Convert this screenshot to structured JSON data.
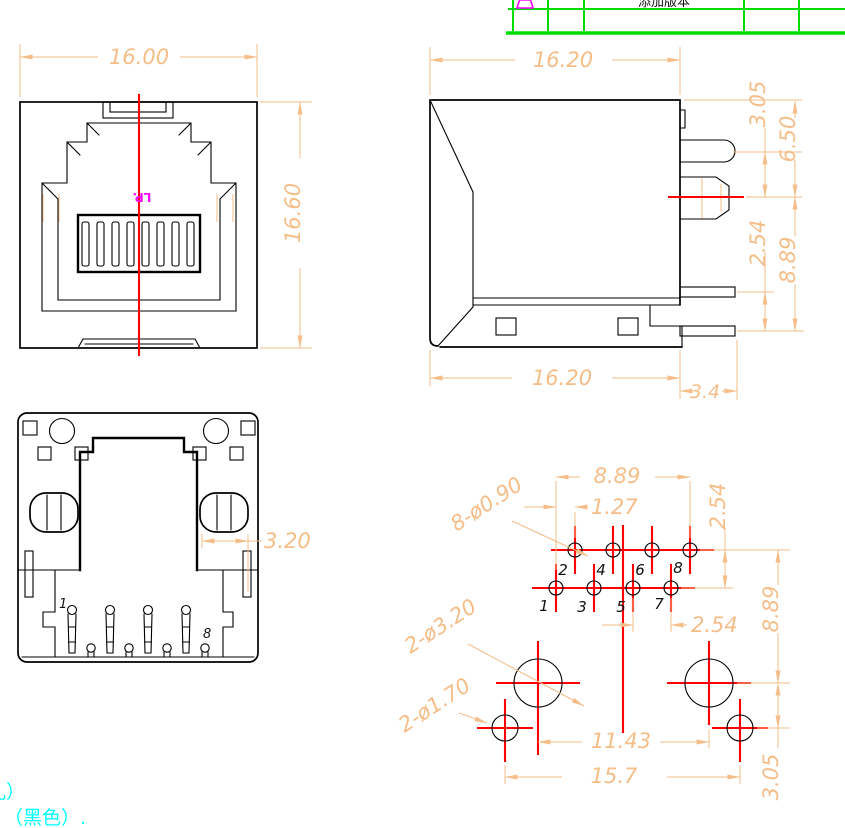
{
  "title_block": {
    "revision_text": "添加版本"
  },
  "front_view": {
    "dim_width": "16.00",
    "dim_height": "16.60",
    "watermark": "LP."
  },
  "side_view": {
    "dim_top_width": "16.20",
    "dim_latch_offset": "3.05",
    "dim_contact_height": "6.50",
    "dim_pin_pitch": "2.54",
    "dim_contact_to_pin": "8.89",
    "dim_bottom_width": "16.20",
    "dim_pin_length": "3.4"
  },
  "bottom_view": {
    "dim_post_slot": "3.20",
    "pin_first": "1",
    "pin_last": "8"
  },
  "footprint": {
    "dim_row_span": "8.89",
    "dim_row_offset": "1.27",
    "dim_row_pitch": "2.54",
    "dim_pin_pitch": "2.54",
    "dim_post_span": "8.89",
    "dim_post_pitch": "11.43",
    "dim_side_span": "15.7",
    "dim_side_offset": "3.05",
    "label_pin_holes": "8-ø0.90",
    "label_post_holes": "2-ø3.20",
    "label_side_holes": "2-ø1.70",
    "pin_numbers": [
      "1",
      "2",
      "3",
      "4",
      "5",
      "6",
      "7",
      "8"
    ]
  },
  "notes": {
    "line1": "孔）",
    "line2": "（黑色）."
  },
  "colors": {
    "outline": "#000000",
    "dimension": "#F5BD88",
    "centerline": "#FF0000",
    "table_border": "#00DC00",
    "revision_marker": "#FF00FF",
    "watermark": "#FF00FF",
    "note_text": "#00FFFF",
    "background": "#FFFFFF"
  }
}
